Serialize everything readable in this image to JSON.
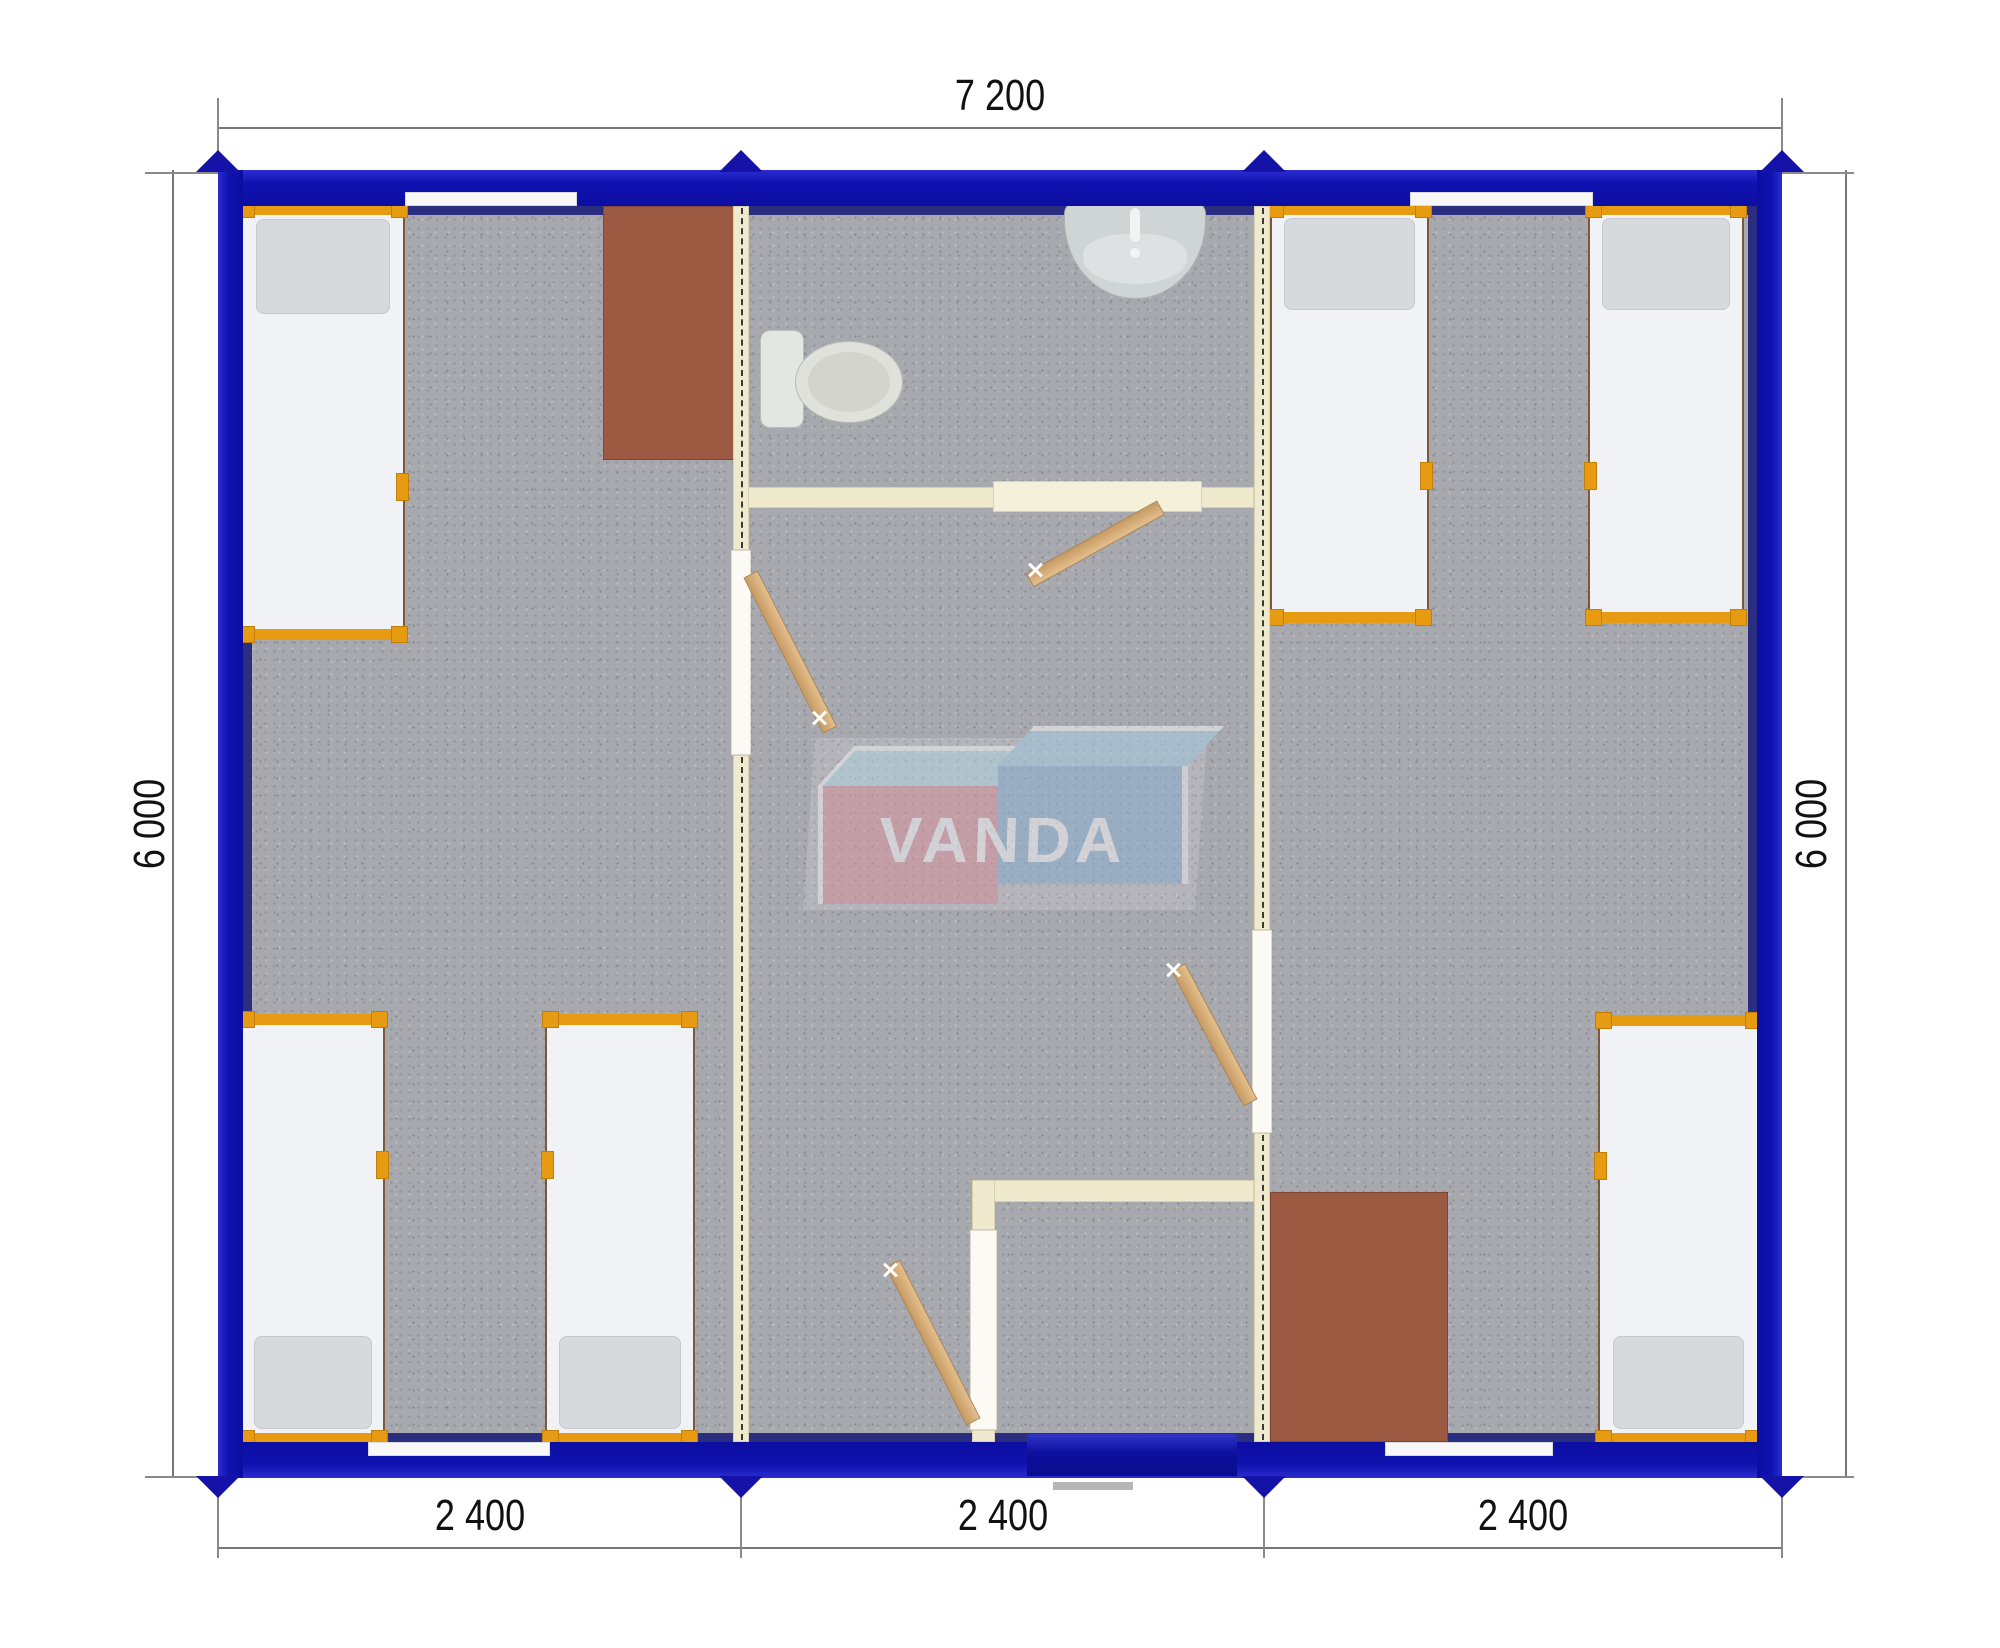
{
  "plan": {
    "watermark": {
      "text": "VANDA"
    },
    "dimensions": {
      "top": "7 200",
      "left": "6 000",
      "right": "6 000",
      "bottom": [
        "2 400",
        "2 400",
        "2 400"
      ]
    },
    "colors": {
      "outer_wall_blue": "#1113b2",
      "wall_lining_navy": "#2b2e80",
      "partition_cream": "#efe9cd",
      "floor_gray": "#a8a8af",
      "bed_frame_orange": "#e79b12",
      "desk_brown": "#9b5a41",
      "door_leaf_tan": "#d3ab77",
      "joint_marker_navy": "#1512a8",
      "logo_pink": "#e0959f",
      "logo_blue": "#8cb4d8",
      "logo_top_face": "#b5dcea"
    },
    "inventory": {
      "beds": 6,
      "desks": 2,
      "toilets": 1,
      "sinks": 1,
      "interior_doors": 4,
      "windows": 4,
      "entrance_doors": 1,
      "modules": 3
    }
  }
}
